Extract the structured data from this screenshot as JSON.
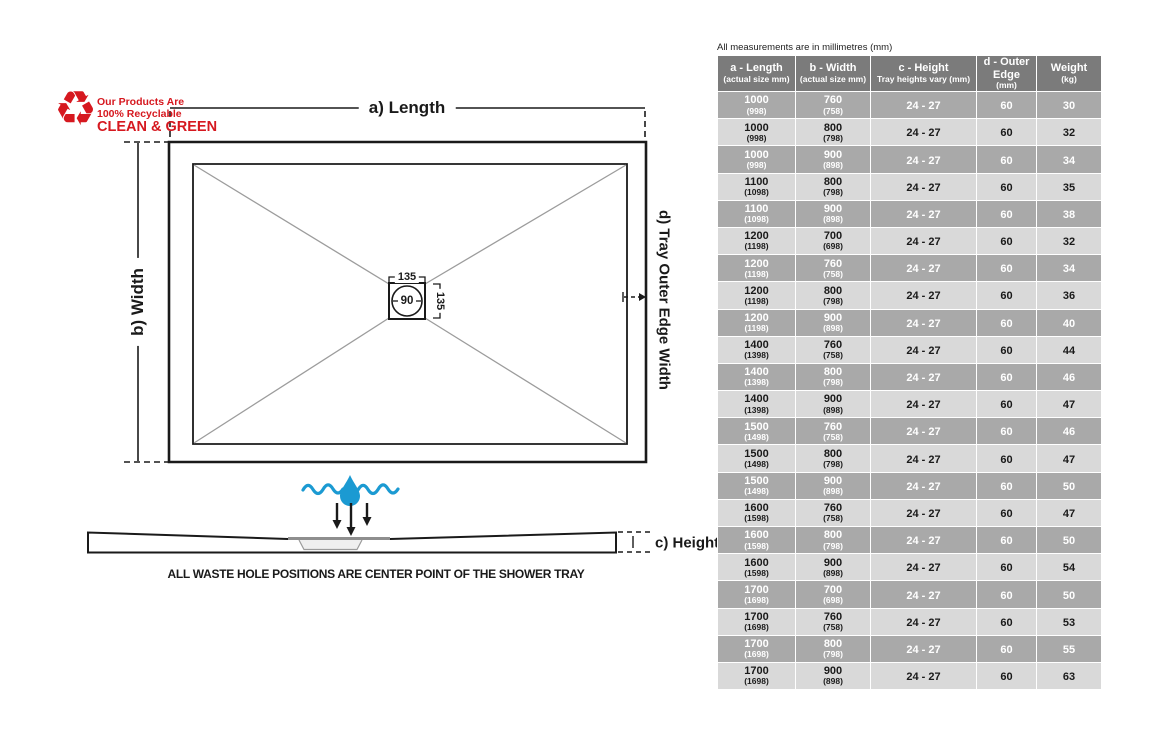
{
  "recycle": {
    "symbol": "♻",
    "line1": "Our Products Are",
    "line2": "100% Recyclable",
    "line3": "CLEAN & GREEN",
    "color": "#d6181f"
  },
  "diagram": {
    "label_a": "a) Length",
    "label_b": "b) Width",
    "label_c": "c) Height",
    "label_d": "d) Tray Outer Edge Width",
    "waste_square_width": "135",
    "waste_square_height": "135",
    "waste_hole_diameter": "90",
    "footnote": "ALL WASTE HOLE POSITIONS ARE CENTER POINT OF THE SHOWER TRAY",
    "water_blue": "#1b9ad2",
    "line_black": "#1a1a1a",
    "diagonal_gray": "#9c9c9c"
  },
  "table": {
    "note": "All measurements are in millimetres (mm)",
    "header_bg": "#7b7b7b",
    "row_dark_bg": "#a9a9a9",
    "row_light_bg": "#d9d9d9",
    "headers": [
      {
        "title": "a - Length",
        "sub": "(actual size mm)"
      },
      {
        "title": "b - Width",
        "sub": "(actual size mm)"
      },
      {
        "title": "c - Height",
        "sub": "Tray heights vary (mm)"
      },
      {
        "title": "d - Outer Edge",
        "sub": "(mm)"
      },
      {
        "title": "Weight",
        "sub": "(kg)"
      }
    ],
    "rows": [
      {
        "a": "1000",
        "a_actual": "(998)",
        "b": "760",
        "b_actual": "(758)",
        "c": "24 - 27",
        "d": "60",
        "w": "30"
      },
      {
        "a": "1000",
        "a_actual": "(998)",
        "b": "800",
        "b_actual": "(798)",
        "c": "24 - 27",
        "d": "60",
        "w": "32"
      },
      {
        "a": "1000",
        "a_actual": "(998)",
        "b": "900",
        "b_actual": "(898)",
        "c": "24 - 27",
        "d": "60",
        "w": "34"
      },
      {
        "a": "1100",
        "a_actual": "(1098)",
        "b": "800",
        "b_actual": "(798)",
        "c": "24 - 27",
        "d": "60",
        "w": "35"
      },
      {
        "a": "1100",
        "a_actual": "(1098)",
        "b": "900",
        "b_actual": "(898)",
        "c": "24 - 27",
        "d": "60",
        "w": "38"
      },
      {
        "a": "1200",
        "a_actual": "(1198)",
        "b": "700",
        "b_actual": "(698)",
        "c": "24 - 27",
        "d": "60",
        "w": "32"
      },
      {
        "a": "1200",
        "a_actual": "(1198)",
        "b": "760",
        "b_actual": "(758)",
        "c": "24 - 27",
        "d": "60",
        "w": "34"
      },
      {
        "a": "1200",
        "a_actual": "(1198)",
        "b": "800",
        "b_actual": "(798)",
        "c": "24 - 27",
        "d": "60",
        "w": "36"
      },
      {
        "a": "1200",
        "a_actual": "(1198)",
        "b": "900",
        "b_actual": "(898)",
        "c": "24 - 27",
        "d": "60",
        "w": "40"
      },
      {
        "a": "1400",
        "a_actual": "(1398)",
        "b": "760",
        "b_actual": "(758)",
        "c": "24 - 27",
        "d": "60",
        "w": "44"
      },
      {
        "a": "1400",
        "a_actual": "(1398)",
        "b": "800",
        "b_actual": "(798)",
        "c": "24 - 27",
        "d": "60",
        "w": "46"
      },
      {
        "a": "1400",
        "a_actual": "(1398)",
        "b": "900",
        "b_actual": "(898)",
        "c": "24 - 27",
        "d": "60",
        "w": "47"
      },
      {
        "a": "1500",
        "a_actual": "(1498)",
        "b": "760",
        "b_actual": "(758)",
        "c": "24 - 27",
        "d": "60",
        "w": "46"
      },
      {
        "a": "1500",
        "a_actual": "(1498)",
        "b": "800",
        "b_actual": "(798)",
        "c": "24 - 27",
        "d": "60",
        "w": "47"
      },
      {
        "a": "1500",
        "a_actual": "(1498)",
        "b": "900",
        "b_actual": "(898)",
        "c": "24 - 27",
        "d": "60",
        "w": "50"
      },
      {
        "a": "1600",
        "a_actual": "(1598)",
        "b": "760",
        "b_actual": "(758)",
        "c": "24 - 27",
        "d": "60",
        "w": "47"
      },
      {
        "a": "1600",
        "a_actual": "(1598)",
        "b": "800",
        "b_actual": "(798)",
        "c": "24 - 27",
        "d": "60",
        "w": "50"
      },
      {
        "a": "1600",
        "a_actual": "(1598)",
        "b": "900",
        "b_actual": "(898)",
        "c": "24 - 27",
        "d": "60",
        "w": "54"
      },
      {
        "a": "1700",
        "a_actual": "(1698)",
        "b": "700",
        "b_actual": "(698)",
        "c": "24 - 27",
        "d": "60",
        "w": "50"
      },
      {
        "a": "1700",
        "a_actual": "(1698)",
        "b": "760",
        "b_actual": "(758)",
        "c": "24 - 27",
        "d": "60",
        "w": "53"
      },
      {
        "a": "1700",
        "a_actual": "(1698)",
        "b": "800",
        "b_actual": "(798)",
        "c": "24 - 27",
        "d": "60",
        "w": "55"
      },
      {
        "a": "1700",
        "a_actual": "(1698)",
        "b": "900",
        "b_actual": "(898)",
        "c": "24 - 27",
        "d": "60",
        "w": "63"
      }
    ]
  }
}
